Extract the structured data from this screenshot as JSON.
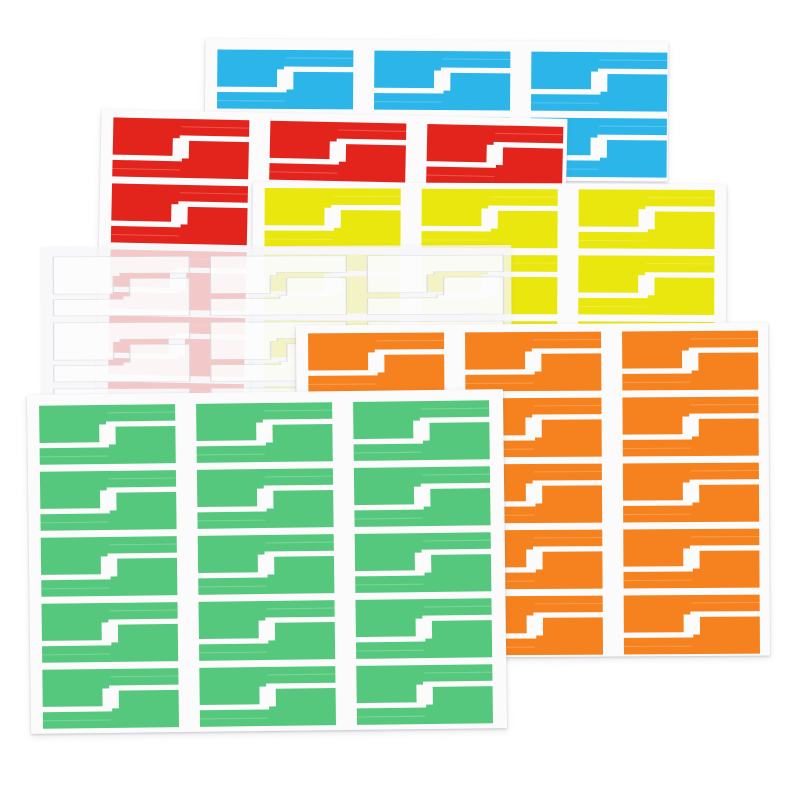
{
  "scene": {
    "subject": "Six overlapping sheets of colorful self-adhesive cable wrap flag label stickers on a white background",
    "background_color": "#ffffff",
    "canvas": {
      "width": 800,
      "height": 800
    },
    "sheet_count": 6,
    "label_pairs_per_sheet": 15,
    "labels_per_sheet": 30,
    "grid_per_sheet": "3 columns x 5 rows of interlocking label pairs"
  },
  "label_geometry": {
    "pair_outline_front": "0,0 100,0 100,28 49,28 49,33 44,33 44,63 0,63",
    "pair_outline_back": "100,100 0,100 0,72 51,72 51,67 56,67 56,37 100,37",
    "tail_highlight_front": {
      "x": 50,
      "y": 12.5,
      "w": 50,
      "h": 1.8
    },
    "tail_highlight_back": {
      "x": 0,
      "y": 85.7,
      "w": 50,
      "h": 1.8
    },
    "tail_highlight_color": "#ffffff",
    "tail_highlight_opacity": 0.22
  },
  "grid": {
    "cols": 3,
    "unit_w": 136,
    "unit_h": 59,
    "col_gap": 21,
    "row_gap": 7,
    "pad_left": 12
  },
  "sheets": [
    {
      "name": "blue",
      "color_name": "sky blue",
      "hex": "#2bb5e8",
      "paper": "#fbfbfc",
      "x": 205,
      "y": 40,
      "w": 463,
      "h": 140,
      "rot": 0.4,
      "z": 1,
      "rows": 2,
      "pad_top": 11
    },
    {
      "name": "red",
      "color_name": "red",
      "hex": "#e3241c",
      "paper": "#fbfbfc",
      "x": 98,
      "y": 114,
      "w": 466,
      "h": 340,
      "rot": 1.2,
      "z": 2,
      "rows": 5,
      "pad_top": 8
    },
    {
      "name": "yellow",
      "color_name": "bright yellow",
      "hex": "#e9e70e",
      "paper": "#fbfbfc",
      "x": 252,
      "y": 183,
      "w": 474,
      "h": 350,
      "rot": 0.25,
      "z": 3,
      "rows": 5,
      "pad_top": 6
    },
    {
      "name": "transparent",
      "color_name": "translucent white",
      "hex": "#fdfdfe",
      "paper": "rgba(246,246,249,0.78)",
      "translucent": true,
      "label_opacity": 0.85,
      "stroke": "#dcdce2",
      "x": 42,
      "y": 246,
      "w": 470,
      "h": 350,
      "rot": -0.25,
      "z": 4,
      "rows": 3,
      "pad_top": 10
    },
    {
      "name": "orange",
      "color_name": "orange",
      "hex": "#f5821e",
      "paper": "#fbfbfc",
      "x": 297,
      "y": 324,
      "w": 472,
      "h": 333,
      "rot": -0.35,
      "z": 5,
      "rows": 5,
      "pad_top": 8
    },
    {
      "name": "green",
      "color_name": "medium green",
      "hex": "#56c87d",
      "paper": "#fbfbfc",
      "x": 29,
      "y": 392,
      "w": 476,
      "h": 339,
      "rot": -0.7,
      "z": 6,
      "rows": 5,
      "pad_top": 11
    }
  ]
}
